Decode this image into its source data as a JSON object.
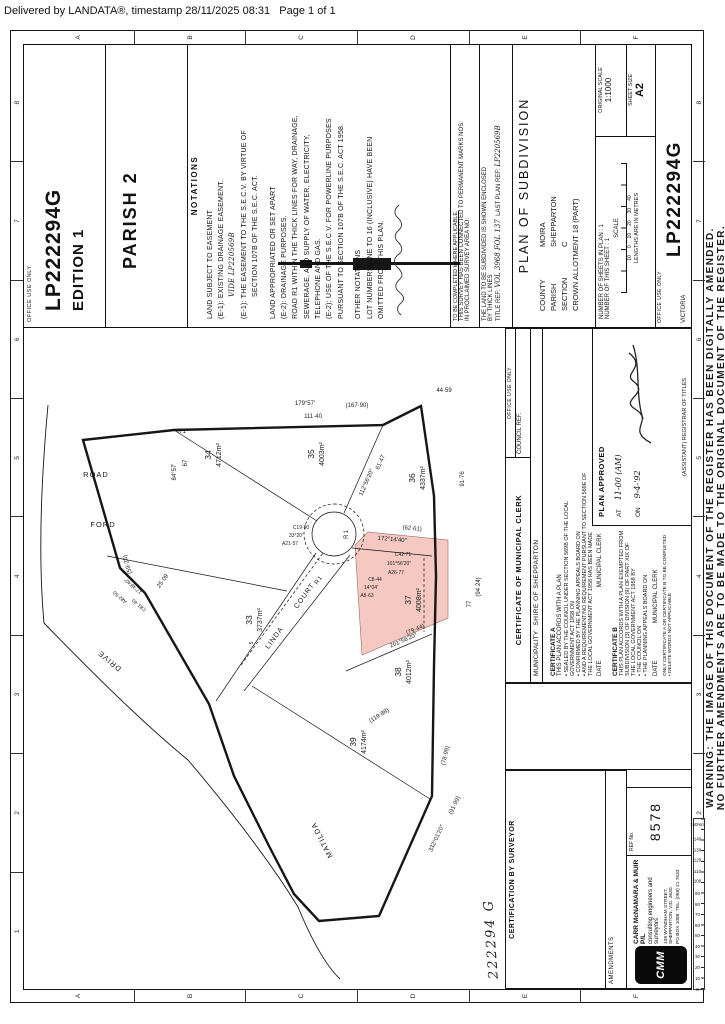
{
  "page": {
    "header": "Delivered by LANDATA®, timestamp 28/11/2025 08:31   Page 1 of 1"
  },
  "warning": {
    "line1": "WARNING: THE IMAGE OF THIS DOCUMENT OF THE REGISTER HAS BEEN DIGITALLY AMENDED.",
    "line2": "NO FURTHER AMENDMENTS ARE TO BE MADE TO THE ORIGINAL DOCUMENT OF THE REGISTER."
  },
  "edition_box": {
    "office_use": "OFFICE USE ONLY",
    "plan": "LP222294G",
    "edition": "EDITION 1"
  },
  "parish_note": "PARISH 2",
  "notations": {
    "header": "NOTATIONS",
    "s1_title": "LAND SUBJECT TO EASEMENT",
    "s1_l1": "(E-1): EXISTING DRAINAGE EASEMENT.",
    "s1_hand": "VIDE LP220569B",
    "s1_l3": "(E-1): THE EASEMENT TO THE S.E.C.V. BY VIRTUE OF",
    "s1_l4": "SECTION 107B OF THE S.E.C. ACT.",
    "s2_title": "LAND APPROPRIATED OR SET APART",
    "s2_l1": "(E-2): DRAINAGE PURPOSES.",
    "s2_l2": "ROAD R1 WITHIN THE THICK LINES FOR WAY, DRAINAGE,",
    "s2_l3": "SEWERAGE, AND SUPPLY OF WATER, ELECTRICITY,",
    "s2_l4": "TELEPHONE AND GAS.",
    "s2_l5": "(E-2): USE OF THE S.E.C.V. FOR POWERLINE PURPOSES",
    "s2_l6": "PURSUANT TO SECTION 107B OF THE S.E.C. ACT 1958.",
    "s3_title": "OTHER NOTATIONS",
    "s3_l1": "LOT NUMBERS ONE TO 16 (INCLUSIVE) HAVE BEEN",
    "s3_l2": "OMITTED FROM THIS PLAN."
  },
  "survey_box": {
    "note": "TO BE COMPLETED WHERE APPLICABLE.",
    "l1": "THIS SURVEY HAS BEEN CONNECTED TO PERMANENT MARKS",
    "l2": "NOS:",
    "l3": "IN PROCLAIMED SURVEY AREA NO:",
    "l4": "THE LAND TO BE SUBDIVIDED IS SHOWN ENCLOSED",
    "l5": "BY THICK LINES",
    "title_ref_label": "TITLE REF:",
    "title_ref": "VOL 3968 FOL 137",
    "last_plan_label": "LAST PLAN REF:",
    "last_plan": "LP220569B"
  },
  "title_block": {
    "title": "PLAN  OF  SUBDIVISION",
    "county_label": "COUNTY",
    "county": "MOIRA",
    "parish_label": "PARISH",
    "parish": "SHEPPARTON",
    "section_label": "SECTION",
    "section": "C",
    "allotment": "CROWN  ALLOTMENT  18  (PART)"
  },
  "sheets_block": {
    "l1": "NUMBER OF SHEETS IN PLAN : 1",
    "l2": "NUMBER OF THIS SHEET : 1",
    "scale_label": "SCALE",
    "scale_ticks": "10     0     10     20     30     40",
    "lengths": "LENGTHS ARE IN METRES",
    "orig_label": "ORIGINAL SCALE",
    "orig_value": "1:1000",
    "sheet_label": "SHEET SIZE",
    "sheet_value": "A2"
  },
  "lp_box": {
    "office_use": "OFFICE USE ONLY",
    "number": "LP222294G",
    "state": "VICTORIA"
  },
  "surveyor_box": {
    "header": "CERTIFICATION  BY  SURVEYOR"
  },
  "stamp": "222294 G",
  "amendments": {
    "header": "AMENDMENTS"
  },
  "firm": {
    "logo": "CMM",
    "name": "CARR  McNAMARA  &  MUIR  P/L",
    "tagline": "consulting engineers and surveyors",
    "addr1": "108 WYNDHAM STREET,",
    "addr2": "SHEPPARTON, VIC. 3630.",
    "addr3": "PO BOX 1088",
    "addr4": "TEL. (058) 21 7633"
  },
  "ref_box": {
    "label": "REF No.",
    "value": "8578"
  },
  "municipal": {
    "header": "CERTIFICATE  OF  MUNICIPAL  CLERK",
    "office_use": "OFFICE USE ONLY",
    "council_ref": "COUNCIL REF.",
    "muni_label": "MUNICIPALITY",
    "muni_value": "SHIRE  OF  SHEPPARTON",
    "certA_title": "CERTIFICATE A",
    "certA_l1": "THIS PLAN ACCORDS WITH A PLAN",
    "certA_b1": "SEALED BY THE COUNCIL UNDER SECTION 569B OF THE LOCAL GOVERNMENT ACT 1958 ON",
    "certA_b2": "CONFIRMED BY THE PLANNING APPEALS BOARD ON",
    "certA_b3": "AND  A REQUIREMENT/NO REQUIREMENT  PURSUANT TO SECTION 569E OF THE LOCAL GOVERNMENT ACT 1958 HAS BEEN MADE",
    "date_label": "DATE",
    "clerk_label": "MUNICIPAL CLERK",
    "certB_title": "CERTIFICATE B",
    "certB_l1": "THIS PLAN ACCORDS WITH A PLAN EXEMPTED FROM SUBDIVISION (3) OF DIVISION (9) OF PART XIX OF",
    "certB_l2": "THE LOCAL GOVERNMENT ACT 1958 BY",
    "certB_b1": "THE COUNCIL ON",
    "certB_b2": "THE PLANNING APPEALS BOARD ON",
    "footer1": "ONLY CERTIFICATE A OR CERTIFICATE B TO BE COMPLETED",
    "footer2": "•  DELETE WORDS NOT APPLICABLE"
  },
  "plan_approved": {
    "title": "PLAN APPROVED",
    "at_label": "AT",
    "at_value": "11-00 (AM)",
    "on_label": "ON",
    "on_value": "9-4-'92",
    "registrar": "(ASSISTANT) REGISTRAR OF TITLES"
  },
  "grid": {
    "numbers": [
      "1",
      "2",
      "3",
      "4",
      "5",
      "6",
      "7",
      "8"
    ],
    "letters": [
      "A",
      "B",
      "C",
      "D",
      "E",
      "F"
    ],
    "ruler": [
      "0",
      "10",
      "20",
      "30",
      "40",
      "50",
      "60",
      "70",
      "80",
      "90",
      "100",
      "110",
      "120",
      "130",
      "140",
      "150mm"
    ]
  },
  "map": {
    "roads": {
      "ford1": "FORD",
      "ford2": "ROAD",
      "matilda": "MATILDA",
      "drive": "DRIVE",
      "linda": "LINDA",
      "court": "COURT",
      "r1a": "R1",
      "r1b": "R1",
      "r1c": "R1"
    },
    "lots": [
      {
        "num": "33",
        "area": "3737m²"
      },
      {
        "num": "34",
        "area": "4712m²"
      },
      {
        "num": "35",
        "area": "4003m²"
      },
      {
        "num": "36",
        "area": "4337m²"
      },
      {
        "num": "37",
        "area": "4008m²"
      },
      {
        "num": "38",
        "area": "4012m²"
      },
      {
        "num": "39",
        "area": "4174m²"
      }
    ],
    "dims": [
      {
        "t": "179°57'"
      },
      {
        "t": "(167·90)"
      },
      {
        "t": "111·40"
      },
      {
        "t": "84°57'"
      },
      {
        "t": "67"
      },
      {
        "t": "(59·26)"
      },
      {
        "t": "25·09"
      },
      {
        "t": "44·59"
      },
      {
        "t": "91·76"
      },
      {
        "t": "77"
      },
      {
        "t": "(94·24)"
      },
      {
        "t": "112°56'20″"
      },
      {
        "t": "61·47"
      },
      {
        "t": "172°14'40″"
      },
      {
        "t": "(62·61)"
      },
      {
        "t": "201°56'20″"
      },
      {
        "t": "(79·44)"
      },
      {
        "t": "(119·88)"
      },
      {
        "t": "332°01'20″"
      },
      {
        "t": "(78·99)"
      },
      {
        "t": "(91·99)"
      },
      {
        "t": "A21·57"
      },
      {
        "t": "33°20'"
      },
      {
        "t": "C19·90"
      },
      {
        "t": "A26·77"
      },
      {
        "t": "101°56'20″"
      },
      {
        "t": "C42·71"
      },
      {
        "t": "A8·63"
      },
      {
        "t": "14°04'"
      },
      {
        "t": "C8·44"
      },
      {
        "t": "A82·50"
      },
      {
        "t": "17°48'40″"
      },
      {
        "t": "C81·40"
      },
      {
        "t": "5"
      }
    ]
  },
  "colors": {
    "highlight": "#f5c8c2",
    "ink": "#161616"
  }
}
